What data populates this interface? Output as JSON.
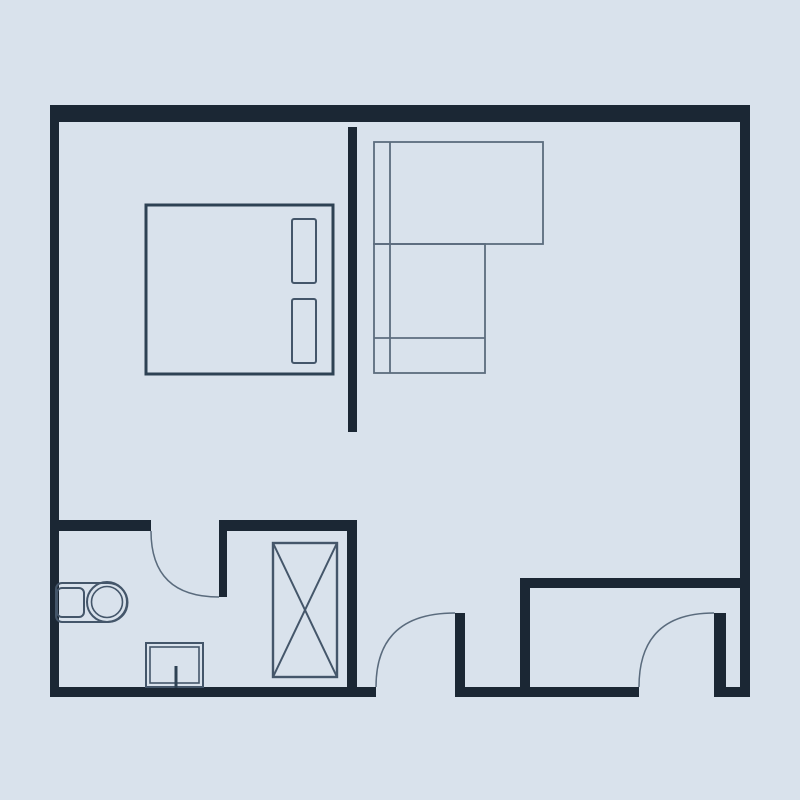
{
  "canvas": {
    "width": 800,
    "height": 800,
    "background": "#d9e2ec"
  },
  "colors": {
    "wall": "#1b2734",
    "bed_stroke": "#2e4254",
    "furniture_stroke": "#44566a",
    "sofa_stroke": "#5c6c7e",
    "arc_stroke": "#5a6b7d"
  },
  "walls": [
    {
      "name": "outer-wall-top",
      "x": 50,
      "y": 105,
      "w": 700,
      "h": 17
    },
    {
      "name": "outer-wall-left",
      "x": 50,
      "y": 105,
      "w": 9,
      "h": 592
    },
    {
      "name": "outer-wall-right",
      "x": 740,
      "y": 105,
      "w": 10,
      "h": 592
    },
    {
      "name": "outer-wall-bottom-left",
      "x": 50,
      "y": 687,
      "w": 326,
      "h": 10
    },
    {
      "name": "outer-wall-bottom-middle",
      "x": 465,
      "y": 687,
      "w": 174,
      "h": 10
    },
    {
      "name": "outer-wall-bottom-right",
      "x": 714,
      "y": 687,
      "w": 36,
      "h": 10
    },
    {
      "name": "partition-bedroom-living",
      "x": 348,
      "y": 127,
      "w": 9,
      "h": 305
    },
    {
      "name": "bathroom-wall-left-segment",
      "x": 59,
      "y": 520,
      "w": 92,
      "h": 11
    },
    {
      "name": "bathroom-closet-wall",
      "x": 219,
      "y": 520,
      "w": 138,
      "h": 11
    },
    {
      "name": "closet-right-wall",
      "x": 347,
      "y": 520,
      "w": 10,
      "h": 167
    },
    {
      "name": "bottomright-room-top-wall",
      "x": 520,
      "y": 578,
      "w": 220,
      "h": 10
    },
    {
      "name": "bottomright-room-left-wall",
      "x": 520,
      "y": 578,
      "w": 10,
      "h": 109
    },
    {
      "name": "bathroom-door-leaf",
      "x": 219,
      "y": 531,
      "w": 8,
      "h": 66
    },
    {
      "name": "entry-door-leaf",
      "x": 455,
      "y": 613,
      "w": 10,
      "h": 84
    },
    {
      "name": "secondary-door-leaf",
      "x": 714,
      "y": 613,
      "w": 12,
      "h": 84
    }
  ],
  "door_arcs": [
    {
      "name": "bathroom-door-arc",
      "d": "M 151 531 Q 151 597 219 597"
    },
    {
      "name": "entry-door-arc",
      "d": "M 376 687 Q 376 613 455 613"
    },
    {
      "name": "secondary-door-arc",
      "d": "M 639 687 Q 639 613 714 613"
    }
  ],
  "furniture": [
    {
      "name": "double-bed-frame",
      "shape": "rect",
      "x": 146,
      "y": 205,
      "w": 187,
      "h": 169,
      "stroke": "bed_stroke",
      "sw": 3
    },
    {
      "name": "bed-pillow-top",
      "shape": "rect",
      "x": 292,
      "y": 219,
      "w": 24,
      "h": 64,
      "rx": 2,
      "stroke": "furniture_stroke",
      "sw": 2
    },
    {
      "name": "bed-pillow-bottom",
      "shape": "rect",
      "x": 292,
      "y": 299,
      "w": 24,
      "h": 64,
      "rx": 2,
      "stroke": "furniture_stroke",
      "sw": 2
    },
    {
      "name": "sofa-back-section",
      "shape": "rect",
      "x": 374,
      "y": 142,
      "w": 169,
      "h": 102,
      "stroke": "sofa_stroke",
      "sw": 1.8
    },
    {
      "name": "sofa-chaise-section",
      "shape": "rect",
      "x": 374,
      "y": 244,
      "w": 111,
      "h": 129,
      "stroke": "sofa_stroke",
      "sw": 1.8
    },
    {
      "name": "sofa-armrest-line",
      "shape": "line",
      "x1": 390,
      "y1": 142,
      "x2": 390,
      "y2": 373,
      "stroke": "sofa_stroke",
      "sw": 1.8
    },
    {
      "name": "sofa-seat-line",
      "shape": "line",
      "x1": 374,
      "y1": 338,
      "x2": 485,
      "y2": 338,
      "stroke": "sofa_stroke",
      "sw": 1.8
    },
    {
      "name": "wardrobe-box",
      "shape": "rect",
      "x": 273,
      "y": 543,
      "w": 64,
      "h": 134,
      "stroke": "furniture_stroke",
      "sw": 2.4
    },
    {
      "name": "wardrobe-cross-line-1",
      "shape": "line",
      "x1": 273,
      "y1": 543,
      "x2": 337,
      "y2": 677,
      "stroke": "furniture_stroke",
      "sw": 2
    },
    {
      "name": "wardrobe-cross-line-2",
      "shape": "line",
      "x1": 337,
      "y1": 543,
      "x2": 273,
      "y2": 677,
      "stroke": "furniture_stroke",
      "sw": 2
    },
    {
      "name": "toilet-body",
      "shape": "path",
      "d": "M 62 583 L 108 583 A 19.5 19.5 0 0 1 108 622 L 62 622 A 6 6 0 0 1 56 616 L 56 589 A 6 6 0 0 1 62 583 Z",
      "stroke": "furniture_stroke",
      "sw": 2
    },
    {
      "name": "toilet-tank",
      "shape": "rect",
      "x": 57,
      "y": 588,
      "w": 27,
      "h": 29,
      "rx": 5,
      "stroke": "furniture_stroke",
      "sw": 2
    },
    {
      "name": "toilet-bowl-outer",
      "shape": "circle",
      "cx": 107,
      "cy": 602,
      "r": 20,
      "stroke": "furniture_stroke",
      "sw": 2
    },
    {
      "name": "toilet-bowl-inner",
      "shape": "circle",
      "cx": 107,
      "cy": 602,
      "r": 15.5,
      "stroke": "furniture_stroke",
      "sw": 1.6
    },
    {
      "name": "basin-outer",
      "shape": "rect",
      "x": 146,
      "y": 643,
      "w": 57,
      "h": 44,
      "stroke": "furniture_stroke",
      "sw": 2
    },
    {
      "name": "basin-inner",
      "shape": "rect",
      "x": 150,
      "y": 647,
      "w": 49,
      "h": 36,
      "stroke": "furniture_stroke",
      "sw": 1.6
    },
    {
      "name": "basin-drain-stub",
      "shape": "line",
      "x1": 176,
      "y1": 666,
      "x2": 176,
      "y2": 688,
      "stroke": "bed_stroke",
      "sw": 3
    }
  ]
}
